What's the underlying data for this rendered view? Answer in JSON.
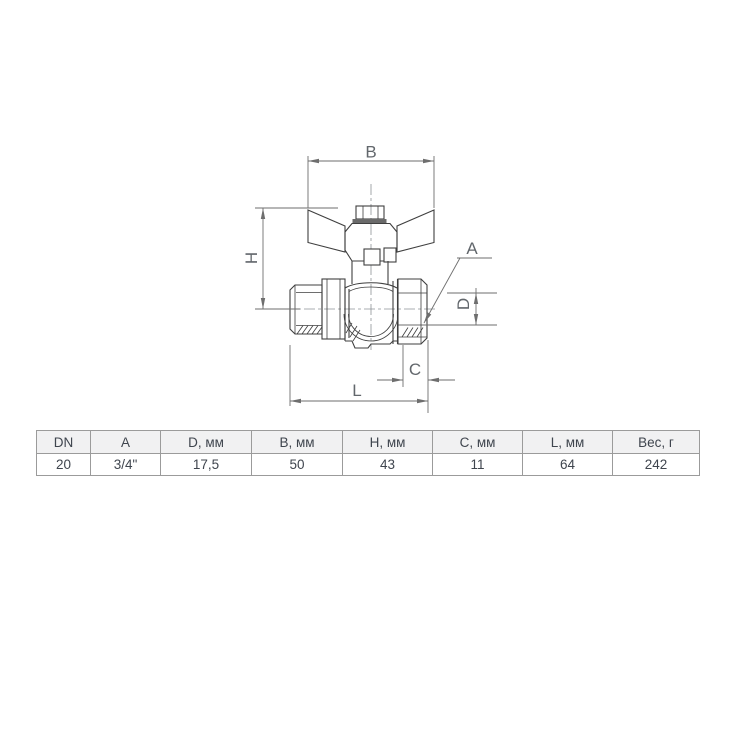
{
  "drawing": {
    "labels": {
      "B": "B",
      "H": "H",
      "A": "A",
      "D": "D",
      "C": "C",
      "L": "L"
    }
  },
  "table": {
    "headers": [
      "DN",
      "A",
      "D, мм",
      "B, мм",
      "H, мм",
      "C, мм",
      "L, мм",
      "Вес, г"
    ],
    "rows": [
      [
        "20",
        "3/4\"",
        "17,5",
        "50",
        "43",
        "11",
        "64",
        "242"
      ]
    ]
  },
  "colors": {
    "part-line": "#3f3f3f",
    "dim-line": "#6e6e6e",
    "label-text": "#62676c",
    "table-border": "#9b9b9b",
    "table-header-bg": "#f1f1f2",
    "table-text": "#3f454e",
    "page-bg": "#ffffff"
  }
}
